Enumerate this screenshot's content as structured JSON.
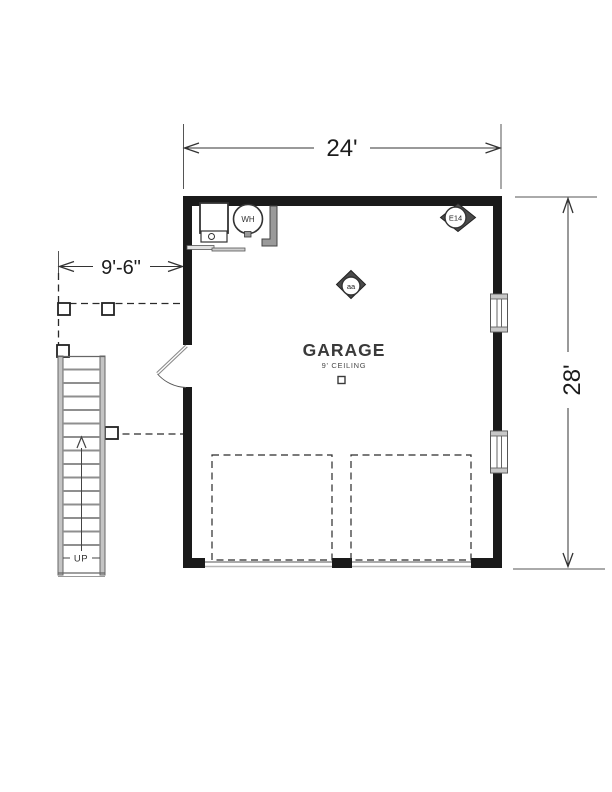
{
  "plan": {
    "room": {
      "name": "GARAGE",
      "ceiling_note": "9' CEILING"
    },
    "dimensions": {
      "top_width": "24'",
      "right_height": "28'",
      "left_porch_width": "9'-6\""
    },
    "labels": {
      "water_heater": "WH",
      "stairs_direction": "UP"
    },
    "markers": {
      "electrical_tag": "E14",
      "ceiling_fixture_tag": "aa"
    },
    "colors": {
      "wall": "#1a1a1a",
      "line": "#333333",
      "gray_fill": "#9a9a9a",
      "background": "#ffffff"
    }
  }
}
